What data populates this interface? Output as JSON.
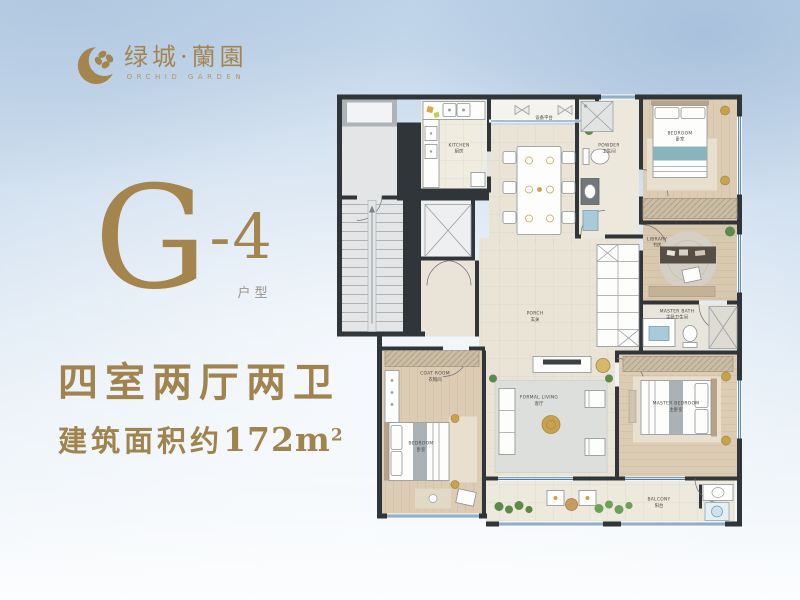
{
  "brand": {
    "name": "绿城·蘭園",
    "subtitle": "ORCHID GARDEN"
  },
  "unit": {
    "code_letter": "G",
    "code_suffix": "-4",
    "code_caption": "户型",
    "headline": "四室两厅两卫",
    "area_label": "建筑面积约",
    "area_number": "172",
    "area_unit": "m",
    "area_exponent": "2"
  },
  "colors": {
    "gold": "#a5854e",
    "wall": "#30353a",
    "window_blue": "#4d7fa6"
  },
  "floorplan": {
    "rooms": {
      "kitchen": {
        "en": "KITCHEN",
        "zh": "厨房"
      },
      "equipment_platform": {
        "zh": "设备平台"
      },
      "powder": {
        "en": "POWDER",
        "zh": "卫生间"
      },
      "bedroom_top": {
        "en": "BEDROOM",
        "zh": "卧室"
      },
      "library": {
        "en": "LIBRARY",
        "zh": "书房"
      },
      "master_bath": {
        "en": "MASTER BATH",
        "zh": "主卧卫生间"
      },
      "porch": {
        "en": "PORCH",
        "zh": "玄关"
      },
      "coat_room": {
        "en": "COAT ROOM",
        "zh": "衣帽间"
      },
      "bedroom_left": {
        "en": "BEDROOM",
        "zh": "卧室"
      },
      "living": {
        "en": "FORMAL LIVING",
        "zh": "客厅"
      },
      "master_bedroom": {
        "en": "MASTER BEDROOM",
        "zh": "主卧室"
      },
      "balcony": {
        "en": "BALCONY",
        "zh": "阳台"
      }
    }
  }
}
